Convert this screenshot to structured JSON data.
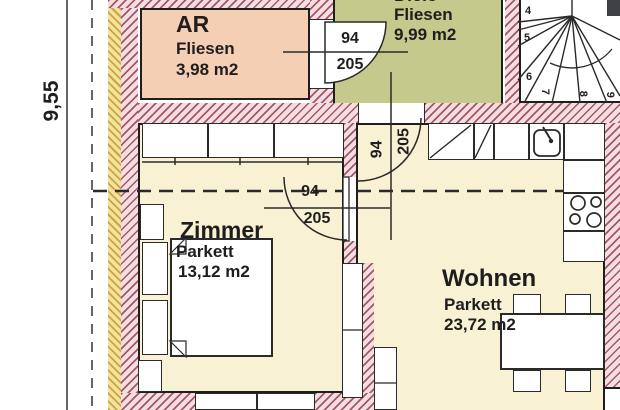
{
  "dimensions": {
    "vertical_total": "9,55"
  },
  "rooms": {
    "ar": {
      "name": "AR",
      "floor": "Fliesen",
      "area": "3,98 m2"
    },
    "diele": {
      "name": "Diele",
      "floor": "Fliesen",
      "area": "9,99 m2"
    },
    "zimmer": {
      "name": "Zimmer",
      "floor": "Parkett",
      "area": "13,12 m2"
    },
    "wohnen": {
      "name": "Wohnen",
      "floor": "Parkett",
      "area": "23,72 m2"
    }
  },
  "doors": {
    "ar_to_diele": {
      "width_cm": "94",
      "height_cm": "205"
    },
    "diele_to_wohnen": {
      "width_cm": "94",
      "height_cm": "205"
    },
    "wohnen_to_zimmer": {
      "width_cm": "94",
      "height_cm": "205"
    }
  },
  "stairs": {
    "step_numbers": [
      "4",
      "5",
      "6",
      "7",
      "8",
      "9"
    ]
  },
  "colors": {
    "floor_parkett": "#f8f1d3",
    "room_ar_fill": "#f5cfb4",
    "room_diele_fill": "#c5c98c",
    "wall_hatch_stripe": "#a85565",
    "wall_hatch_bg": "#f3dfe2",
    "insulation_fill": "#f2e29b"
  }
}
